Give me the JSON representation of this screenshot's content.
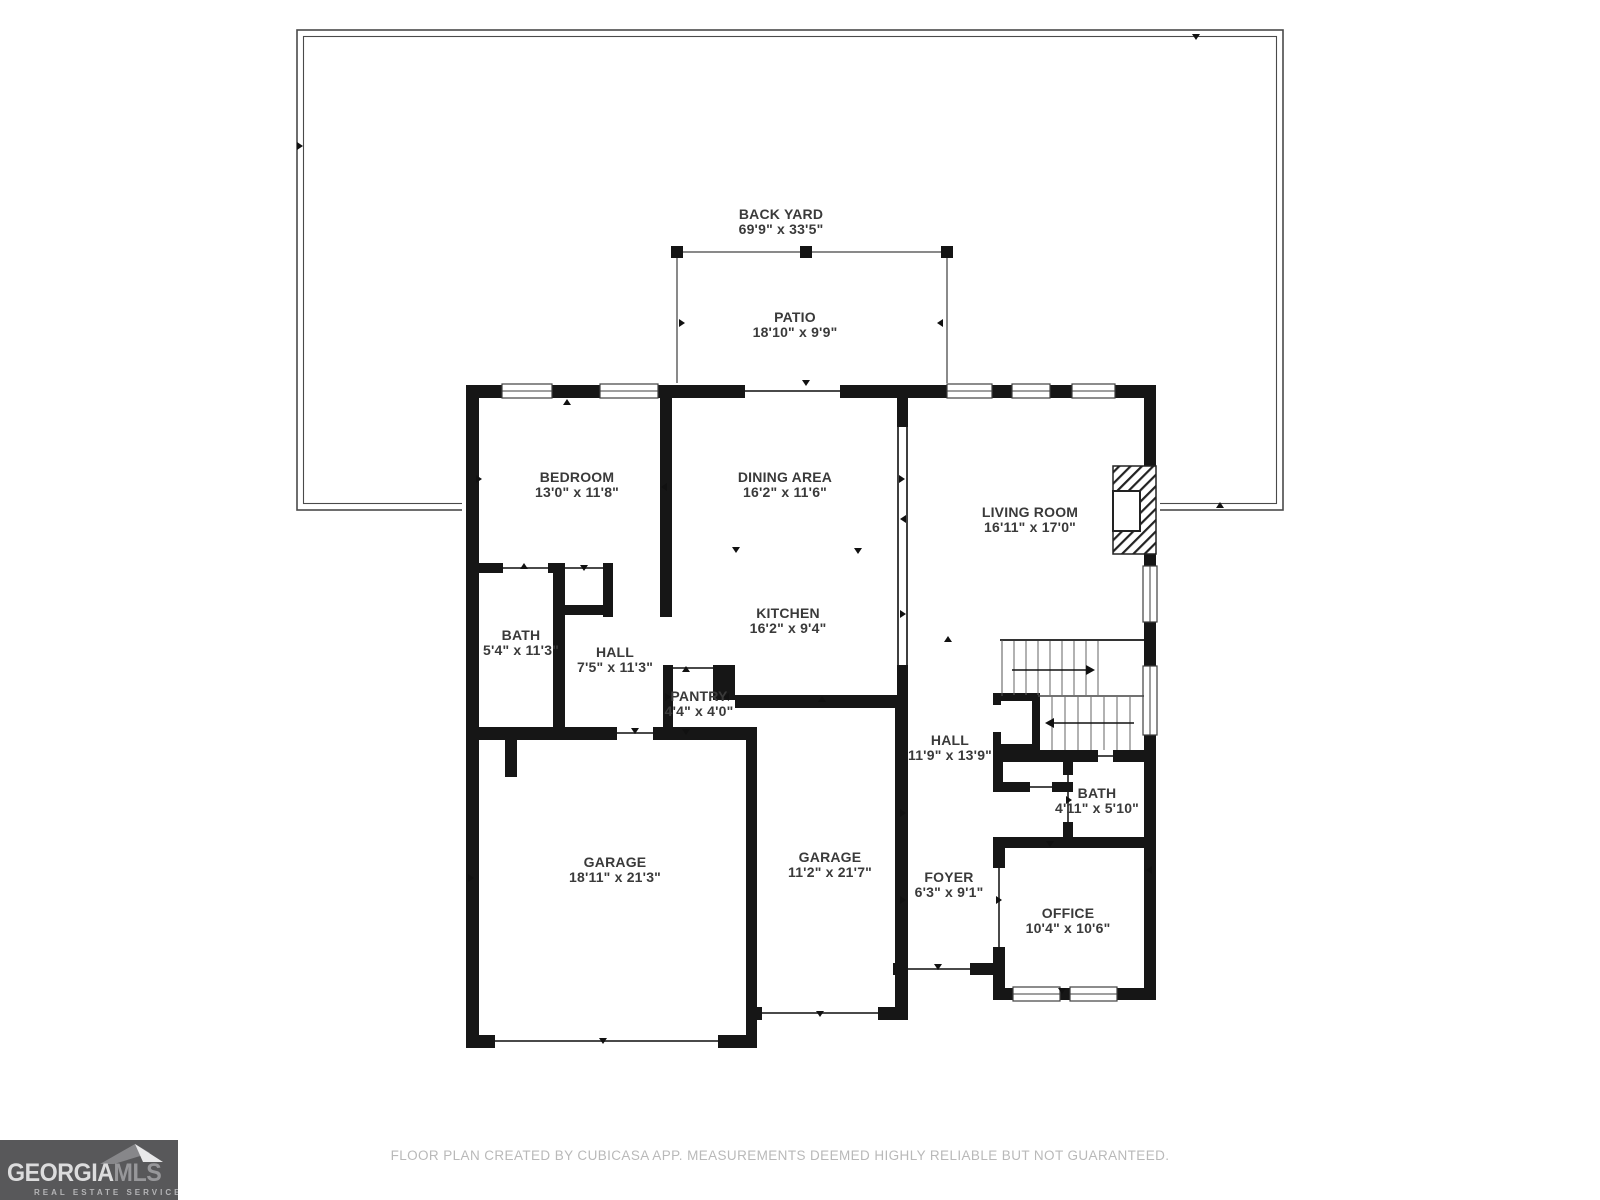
{
  "page": {
    "background": "#ffffff"
  },
  "footer": {
    "disclaimer": "FLOOR PLAN CREATED BY CUBICASA APP. MEASUREMENTS DEEMED HIGHLY RELIABLE BUT NOT GUARANTEED."
  },
  "branding": {
    "name_primary": "GEORGIA",
    "name_secondary": "MLS",
    "tagline": "REAL ESTATE SERVICES",
    "logo_bg": "#58585a"
  },
  "colors": {
    "wall": "#161616",
    "thin_line": "#3f3f3f",
    "label_text": "#3a3a3a",
    "footer_text": "#b9b9b9"
  },
  "rooms": [
    {
      "name": "BACK YARD",
      "dims": "69'9\" x 33'5\""
    },
    {
      "name": "PATIO",
      "dims": "18'10\" x 9'9\""
    },
    {
      "name": "BEDROOM",
      "dims": "13'0\" x 11'8\""
    },
    {
      "name": "DINING AREA",
      "dims": "16'2\" x 11'6\""
    },
    {
      "name": "LIVING ROOM",
      "dims": "16'11\" x 17'0\""
    },
    {
      "name": "BATH",
      "dims": "5'4\" x 11'3\""
    },
    {
      "name": "HALL",
      "dims": "7'5\" x 11'3\""
    },
    {
      "name": "KITCHEN",
      "dims": "16'2\" x 9'4\""
    },
    {
      "name": "PANTRY",
      "dims": "4'4\" x 4'0\""
    },
    {
      "name": "HALL",
      "dims": "11'9\" x 13'9\""
    },
    {
      "name": "BATH",
      "dims": "4'11\" x 5'10\""
    },
    {
      "name": "GARAGE",
      "dims": "18'11\" x 21'3\""
    },
    {
      "name": "GARAGE",
      "dims": "11'2\" x 21'7\""
    },
    {
      "name": "FOYER",
      "dims": "6'3\" x 9'1\""
    },
    {
      "name": "OFFICE",
      "dims": "10'4\" x 10'6\""
    }
  ]
}
